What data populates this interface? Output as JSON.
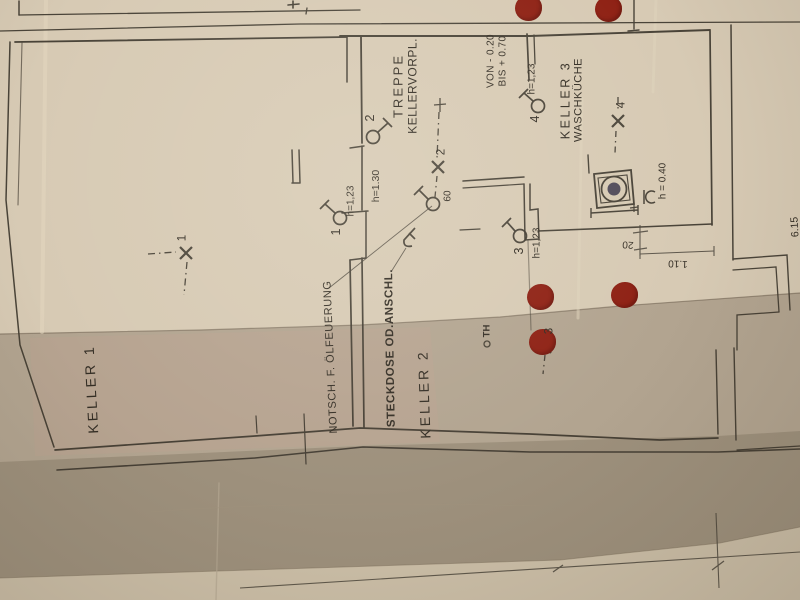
{
  "plan": {
    "rooms": [
      {
        "name": "KELLER 1"
      },
      {
        "name": "KELLER 2"
      },
      {
        "name": "KELLER 3",
        "subname": "WASCHKÜCHE"
      },
      {
        "name": "TREPPE",
        "subname": "KELLERVORPL."
      }
    ],
    "labels": {
      "oil_switch": "NOTSCH. F. ÖLFEUERUNG",
      "socket": "STECKDOSE OD.ANSCHL.",
      "stair_from": "VON - 0.20",
      "stair_to": "BIS + 0.70",
      "thermostat": "TH",
      "sink_height": "h = 0.40",
      "stair_door_height": "h=1.30"
    },
    "wall_lights": [
      {
        "no": "1",
        "height": "h=1,23"
      },
      {
        "no": "2",
        "height": "h=1.30"
      },
      {
        "no": "3",
        "height": "h=1,23"
      },
      {
        "no": "4",
        "height": "h=1,23"
      }
    ],
    "ceiling_lights": [
      {
        "no": "1"
      },
      {
        "no": "2"
      },
      {
        "no": "3"
      },
      {
        "no": "4"
      }
    ],
    "dimensions": {
      "door_width": "60",
      "step_depth": "20",
      "opening_width": "1.10",
      "edge_length": "6.15"
    },
    "markers": {
      "color": "#8e2013"
    }
  }
}
